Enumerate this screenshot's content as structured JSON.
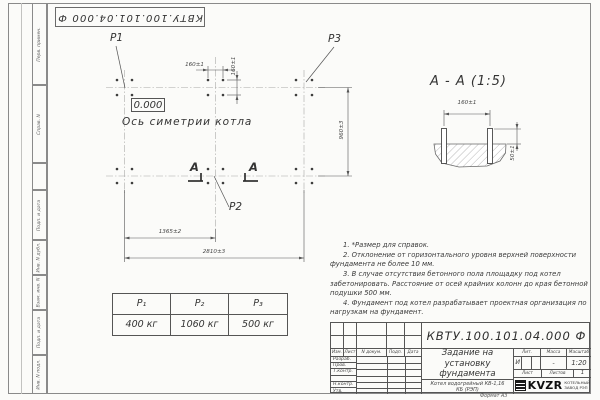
{
  "stamp_top": "КВТУ.100.101.04.000  Ф",
  "margin": {
    "items": [
      "Перв. примен.",
      "Справ. N",
      "Подп. и дата",
      "Инв. N дубл.",
      "Взам. инв. N",
      "Подп. и дата",
      "Инв. N подл."
    ]
  },
  "plan": {
    "p1": "P1",
    "p2": "P2",
    "p3": "P3",
    "elevation": "0.000",
    "axis_label": "Ось симетрии котла",
    "section_letter": "А",
    "dim_160_h": "160±1",
    "dim_160_v": "160±1",
    "dim_960": "960±3",
    "dim_1365": "1365±2",
    "dim_2810": "2810±3"
  },
  "section_view": {
    "title": "А - А (1:5)",
    "dim_160": "160±1",
    "dim_50": "50±1"
  },
  "notes": [
    "1. *Размер для справок.",
    "2. Отклонение от горизонтального уровня верхней поверхности фундамента не более 10 мм.",
    "3. В случае отсутствия бетонного пола площадку под котел забетонировать. Расстояние от осей крайних колонн до края бетонной подушки 500 мм.",
    "4. Фундамент под котел разрабатывает проектная организация по нагрузкам на фундамент."
  ],
  "load_table": {
    "headers": [
      "P₁",
      "P₂",
      "P₃"
    ],
    "values": [
      "400 кг",
      "1060 кг",
      "500 кг"
    ]
  },
  "title_block": {
    "doc_number": "КВТУ.100.101.04.000  Ф",
    "title": "Задание на установку фундамента",
    "product": "Котел водогрейный КВ-1,16 КБ (РЭП)",
    "header_cols": [
      "Изм.",
      "Лист",
      "N докум.",
      "Подп.",
      "Дата"
    ],
    "row_labels": [
      "Разраб.",
      "Пров.",
      "Т.контр.",
      "",
      "Н.контр.",
      "Утв."
    ],
    "lit_label": "Лит.",
    "lit_value": "И",
    "mass_label": "Масса",
    "mass_value": "-",
    "scale_label": "Масштаб",
    "scale_value": "1:20",
    "sheet_label": "Лист",
    "sheets_label": "Листов",
    "sheets_value": "1",
    "logo_text": "KVZR",
    "factory": "КОТЕЛЬНЫЙ ЗАВОД РЭП",
    "format": "Формат А3"
  }
}
